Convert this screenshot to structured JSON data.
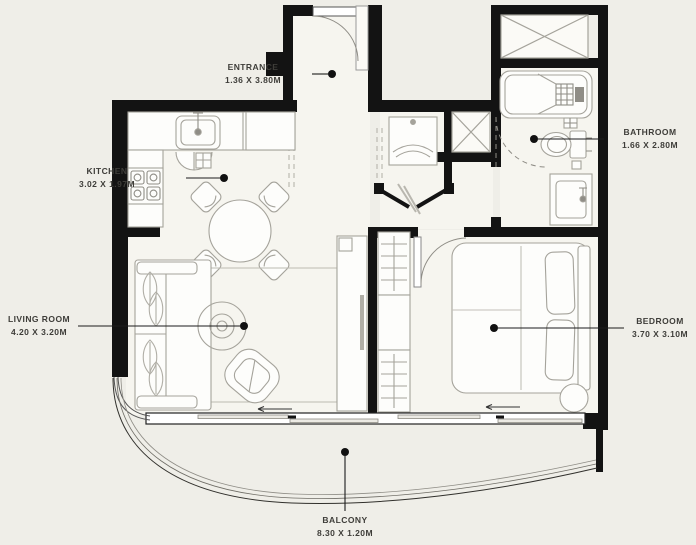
{
  "plan": {
    "title": "apartment-floor-plan",
    "labels": {
      "entrance": {
        "name": "ENTRANCE",
        "dims": "1.36 X 3.80M"
      },
      "kitchen": {
        "name": "KITCHEN",
        "dims": "3.02 X 1.97M"
      },
      "living_room": {
        "name": "LIVING ROOM",
        "dims": "4.20 X 3.20M"
      },
      "bathroom": {
        "name": "BATHROOM",
        "dims": "1.66 X 2.80M"
      },
      "bedroom": {
        "name": "BEDROOM",
        "dims": "3.70 X 3.10M"
      },
      "balcony": {
        "name": "BALCONY",
        "dims": "8.30 X 1.20M"
      }
    },
    "colors": {
      "background": "#efeee8",
      "floor": "#f6f5ef",
      "wall": "#131313",
      "furniture_line": "#a5a39b",
      "label_text": "#3e3d39",
      "leader_line": "#1c1c1c"
    }
  }
}
